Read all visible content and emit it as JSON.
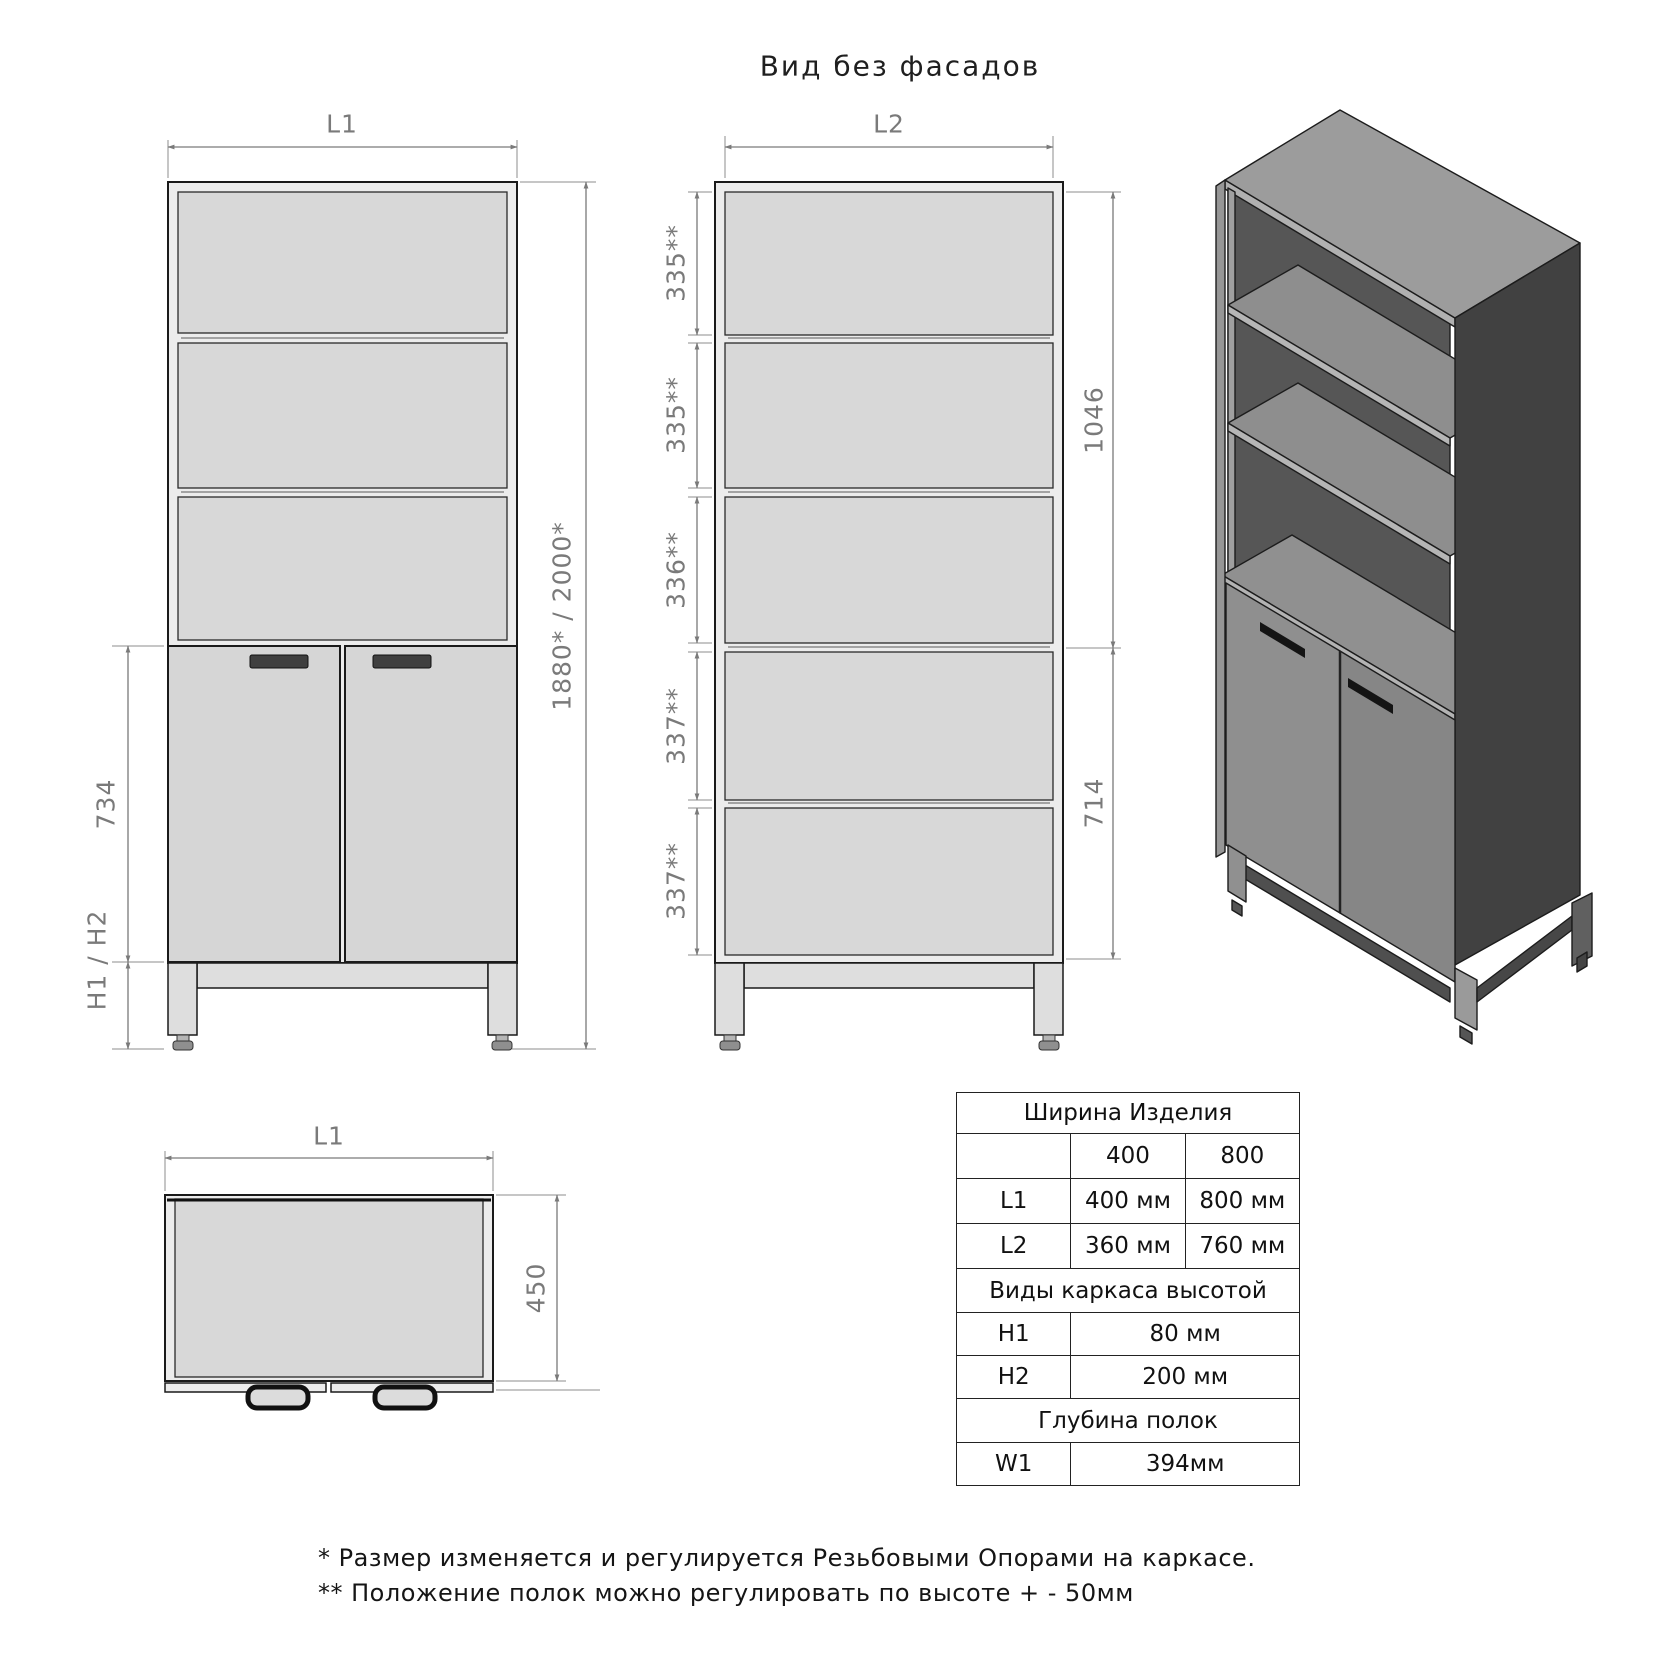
{
  "title": "Вид без фасадов",
  "views": {
    "front": {
      "width_label": "L1",
      "total_height": "1880* / 2000*",
      "door_section_height": "734",
      "frame_height_label": "H1 / H2"
    },
    "internal": {
      "width_label": "L2",
      "shelf_spacings": [
        "335**",
        "335**",
        "336**",
        "337**",
        "337**"
      ],
      "upper_section_height": "1046",
      "lower_section_height": "714"
    },
    "top": {
      "width_label": "L1",
      "depth": "450"
    }
  },
  "table": {
    "width_header": "Ширина Изделия",
    "variant_row": {
      "c400": "400",
      "c800": "800"
    },
    "dim_rows": [
      {
        "label": "L1",
        "v400": "400 мм",
        "v800": "800 мм"
      },
      {
        "label": "L2",
        "v400": "360 мм",
        "v800": "760 мм"
      }
    ],
    "frame_header": "Виды каркаса высотой",
    "frame_rows": [
      {
        "label": "H1",
        "value": "80 мм"
      },
      {
        "label": "H2",
        "value": "200 мм"
      }
    ],
    "depth_header": "Глубина полок",
    "depth_rows": [
      {
        "label": "W1",
        "value": "394мм"
      }
    ]
  },
  "notes": [
    "* Размер изменяется и регулируется Резьбовыми Опорами на каркасе.",
    "** Положение полок можно регулировать по высоте + - 50мм"
  ],
  "colors": {
    "line": "#1a1a1a",
    "dimension": "#7a7a7a",
    "fill_light": "#d8d8d8",
    "fill_panel": "#ececec",
    "iso_dark_side": "#414141"
  }
}
